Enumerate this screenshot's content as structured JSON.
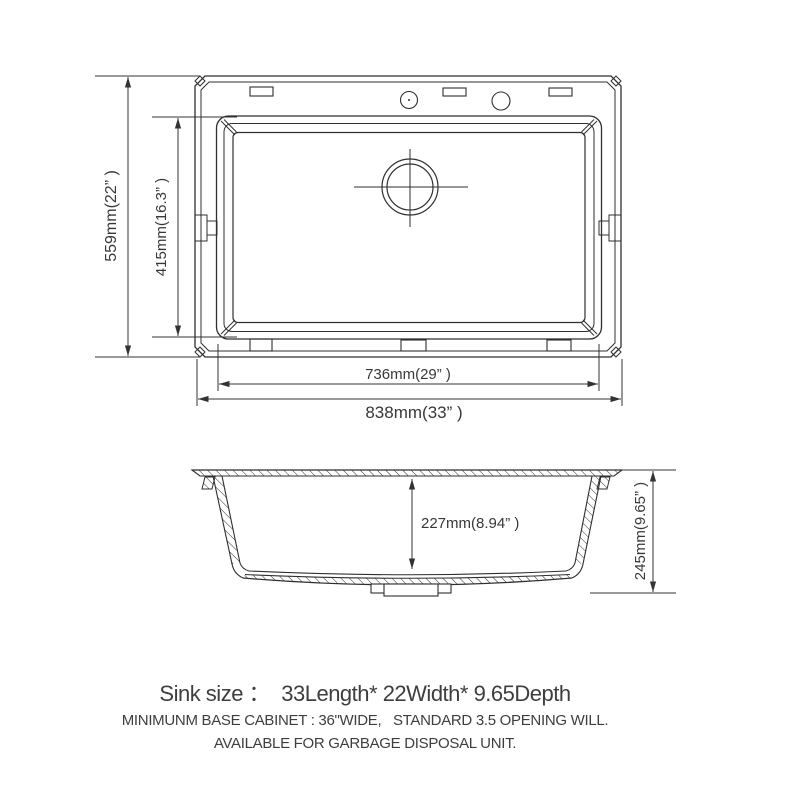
{
  "title": "Kitchen sink dimension drawing",
  "top_view": {
    "name": "top view of drop-in sink",
    "dims": {
      "overall_depth": "559mm(22” )",
      "bowl_depth_front_back": "415mm(16.3” )",
      "bowl_width": "736mm(29” )",
      "overall_width": "838mm(33” )"
    },
    "features": {
      "faucet_holes": 2,
      "mounting_tabs_top": 3,
      "mounting_tabs_bottom": 3,
      "side_clips": 2,
      "drain": "circular drain with crosshair center mark, rear-center position"
    }
  },
  "side_view": {
    "name": "cross-section side view",
    "dims": {
      "bowl_inner_depth": "227mm(8.94” )",
      "overall_height": "245mm(9.65” )"
    },
    "features": {
      "hatched_walls": true,
      "drain_fitting": "stepped drain flange at bottom center"
    }
  },
  "footer": {
    "size_line": "Sink size ：  33Length* 22Width* 9.65Depth",
    "note_line_1": "MINIMUNM BASE CABINET : 36\"WIDE,   STANDARD 3.5 OPENING WILL.",
    "note_line_2": "AVAILABLE FOR GARBAGE DISPOSAL UNIT."
  },
  "colors": {
    "line": "#2f2f2f",
    "dim_line": "#333333",
    "text": "#3e3e3e",
    "background": "#ffffff"
  }
}
